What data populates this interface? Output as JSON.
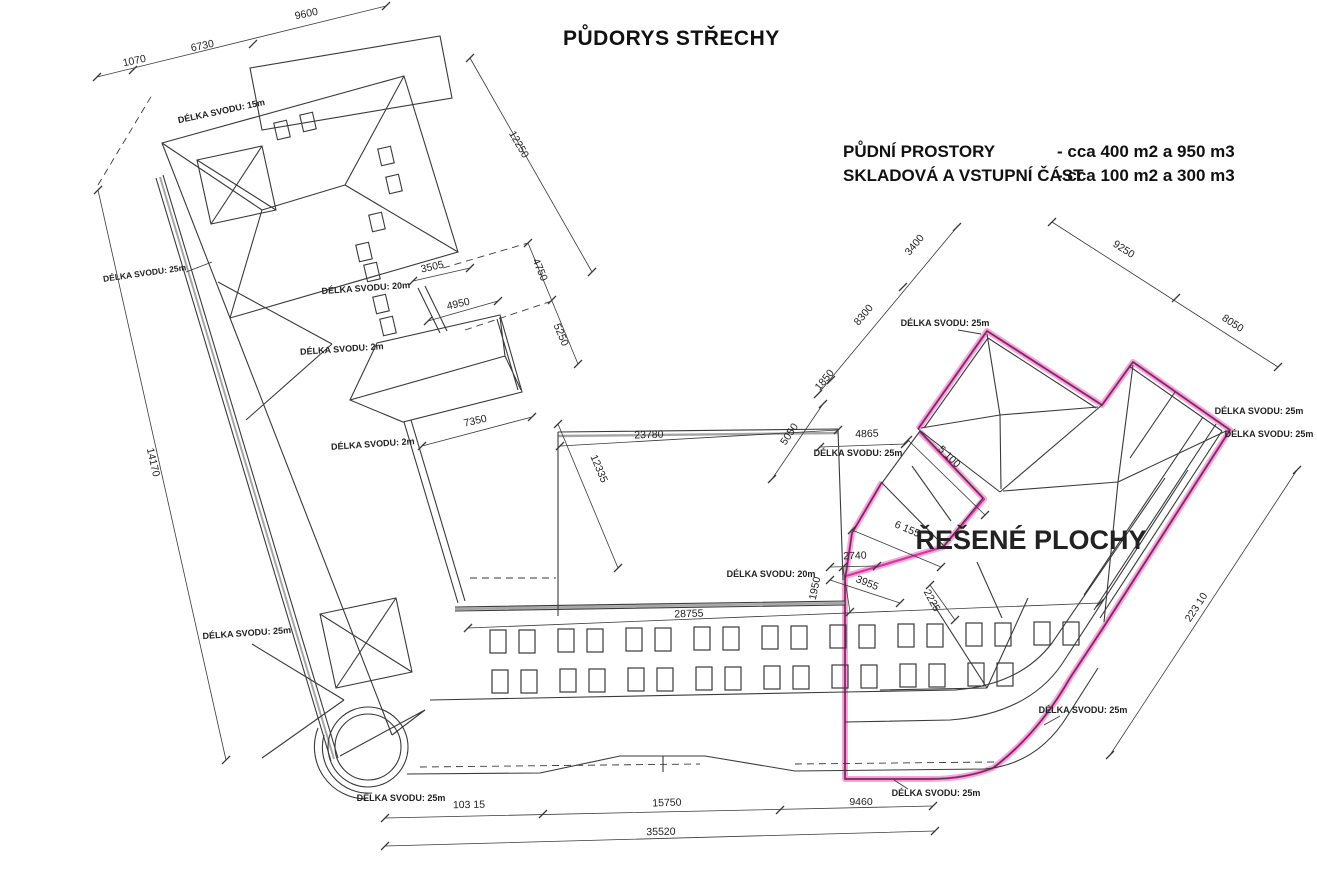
{
  "title": "PŮDORYS STŘECHY",
  "notes": {
    "line1_label": "PŮDNÍ PROSTORY",
    "line1_value": "- cca 400 m2 a 950 m3",
    "line2_label": "SKLADOVÁ A VSTUPNÍ ČÁST",
    "line2_value": "- cca 100 m2 a 300 m3"
  },
  "colors": {
    "background": "#ffffff",
    "ink": "#3a3a3a",
    "grey": "#a6a6a6",
    "highlight": "#d5359f",
    "highlight_light": "#f6a8dd"
  },
  "labels": [
    {
      "name": "dim-1070",
      "text": "1070",
      "x": 135,
      "y": 64,
      "rot": -12,
      "size": 10.5
    },
    {
      "name": "dim-6730",
      "text": "6730",
      "x": 203,
      "y": 49,
      "rot": -12,
      "size": 10.5
    },
    {
      "name": "dim-9600",
      "text": "9600",
      "x": 307,
      "y": 17,
      "rot": -12,
      "size": 10.5
    },
    {
      "name": "dim-12250",
      "text": "12250",
      "x": 516,
      "y": 146,
      "rot": 60,
      "size": 10.5
    },
    {
      "name": "dim-14170",
      "text": "14170",
      "x": 150,
      "y": 463,
      "rot": 77,
      "size": 10.5
    },
    {
      "name": "dim-3505",
      "text": "3505",
      "x": 433,
      "y": 270,
      "rot": -13,
      "size": 10.5
    },
    {
      "name": "dim-4950",
      "text": "4950",
      "x": 459,
      "y": 307,
      "rot": -13,
      "size": 10.5
    },
    {
      "name": "dim-4750",
      "text": "4750",
      "x": 537,
      "y": 271,
      "rot": 67,
      "size": 10.5
    },
    {
      "name": "dim-5250",
      "text": "5250",
      "x": 558,
      "y": 336,
      "rot": 67,
      "size": 10.5
    },
    {
      "name": "dim-7350",
      "text": "7350",
      "x": 476,
      "y": 424,
      "rot": -13,
      "size": 10.5
    },
    {
      "name": "dim-23780",
      "text": "23780",
      "x": 649,
      "y": 438,
      "rot": -2,
      "size": 10.5
    },
    {
      "name": "dim-12335",
      "text": "12335",
      "x": 596,
      "y": 470,
      "rot": 67,
      "size": 10.5
    },
    {
      "name": "dim-5050",
      "text": "5050",
      "x": 792,
      "y": 436,
      "rot": -56,
      "size": 10.5
    },
    {
      "name": "dim-1950",
      "text": "1950",
      "x": 818,
      "y": 589,
      "rot": -78,
      "size": 10.5
    },
    {
      "name": "dim-28755",
      "text": "28755",
      "x": 689,
      "y": 617,
      "rot": -2,
      "size": 10.5
    },
    {
      "name": "dim-3400",
      "text": "3400",
      "x": 917,
      "y": 247,
      "rot": -50,
      "size": 10.5
    },
    {
      "name": "dim-8300",
      "text": "8300",
      "x": 866,
      "y": 317,
      "rot": -50,
      "size": 10.5
    },
    {
      "name": "dim-1850",
      "text": "1850",
      "x": 827,
      "y": 382,
      "rot": -50,
      "size": 10.5
    },
    {
      "name": "dim-4865",
      "text": "4865",
      "x": 867,
      "y": 437,
      "rot": -2,
      "size": 10.5
    },
    {
      "name": "dim-5100",
      "text": "5 100",
      "x": 947,
      "y": 459,
      "rot": 44,
      "size": 10.5
    },
    {
      "name": "dim-9250",
      "text": "9250",
      "x": 1122,
      "y": 252,
      "rot": 33,
      "size": 10.5
    },
    {
      "name": "dim-8050",
      "text": "8050",
      "x": 1231,
      "y": 326,
      "rot": 33,
      "size": 10.5
    },
    {
      "name": "dim-6155",
      "text": "6 155",
      "x": 906,
      "y": 532,
      "rot": 23,
      "size": 10.5
    },
    {
      "name": "dim-2740",
      "text": "2740",
      "x": 855,
      "y": 559,
      "rot": -2,
      "size": 10.5
    },
    {
      "name": "dim-3955",
      "text": "3955",
      "x": 866,
      "y": 586,
      "rot": 22,
      "size": 10.5
    },
    {
      "name": "dim-2225",
      "text": "2225",
      "x": 929,
      "y": 602,
      "rot": 62,
      "size": 10.5
    },
    {
      "name": "dim-22310",
      "text": "223 10",
      "x": 1199,
      "y": 609,
      "rot": -57,
      "size": 10.5
    },
    {
      "name": "dim-9460",
      "text": "9460",
      "x": 861,
      "y": 805,
      "rot": 0,
      "size": 10.5
    },
    {
      "name": "dim-10315",
      "text": "103 15",
      "x": 469,
      "y": 808,
      "rot": -1,
      "size": 10.5
    },
    {
      "name": "dim-15750",
      "text": "15750",
      "x": 667,
      "y": 806,
      "rot": -2,
      "size": 10.5
    },
    {
      "name": "dim-35520",
      "text": "35520",
      "x": 661,
      "y": 835,
      "rot": -1,
      "size": 10.5
    },
    {
      "name": "svod-label-15m",
      "text": "DÉLKA SVODU: 15m",
      "x": 222,
      "y": 114,
      "rot": -12,
      "size": 9,
      "w": 600
    },
    {
      "name": "svod-label-25m-left",
      "text": "DÉLKA SVODU: 25m",
      "x": 145,
      "y": 276,
      "rot": -8,
      "size": 8.5,
      "w": 600
    },
    {
      "name": "svod-label-20m-neck",
      "text": "DÉLKA SVODU: 20m",
      "x": 366,
      "y": 291,
      "rot": -4,
      "size": 9,
      "w": 600
    },
    {
      "name": "svod-label-2m-upper",
      "text": "DÉLKA SVODU: 2m",
      "x": 342,
      "y": 352,
      "rot": -4,
      "size": 9,
      "w": 600
    },
    {
      "name": "svod-label-2m-lower",
      "text": "DÉLKA SVODU: 2m",
      "x": 373,
      "y": 447,
      "rot": -4,
      "size": 9,
      "w": 600
    },
    {
      "name": "svod-label-25m-lowerleft",
      "text": "DÉLKA SVODU: 25m",
      "x": 247,
      "y": 636,
      "rot": -4,
      "size": 9,
      "w": 600
    },
    {
      "name": "svod-label-20m-court",
      "text": "DÉLKA SVODU: 20m",
      "x": 771,
      "y": 577,
      "rot": 0,
      "size": 9,
      "w": 600
    },
    {
      "name": "svod-label-25m-nw",
      "text": "DÉLKA SVODU: 25m",
      "x": 945,
      "y": 326,
      "rot": 0,
      "size": 9,
      "w": 600
    },
    {
      "name": "svod-label-25m-west",
      "text": "DÉLKA SVODU: 25m",
      "x": 858,
      "y": 456,
      "rot": 0,
      "size": 9,
      "w": 600
    },
    {
      "name": "svod-label-25m-right-1",
      "text": "DÉLKA SVODU: 25m",
      "x": 1259,
      "y": 414,
      "rot": 0,
      "size": 9,
      "w": 600
    },
    {
      "name": "svod-label-25m-right-2",
      "text": "DÉLKA SVODU: 25m",
      "x": 1269,
      "y": 437,
      "rot": 0,
      "size": 9,
      "w": 600
    },
    {
      "name": "svod-label-25m-curve",
      "text": "DÉLKA SVODU: 25m",
      "x": 1083,
      "y": 713,
      "rot": 0,
      "size": 9,
      "w": 600
    },
    {
      "name": "svod-label-25m-bottom-mid",
      "text": "DÉLKA SVODU: 25m",
      "x": 936,
      "y": 796,
      "rot": 0,
      "size": 9,
      "w": 600
    },
    {
      "name": "svod-label-25m-bottom-left",
      "text": "DÉLKA SVODU: 25m",
      "x": 401,
      "y": 801,
      "rot": 0,
      "size": 9,
      "w": 600
    },
    {
      "name": "area-title",
      "text": "ŘEŠENÉ PLOCHY",
      "x": 1031,
      "y": 549,
      "rot": 0,
      "size": 27,
      "w": 700
    }
  ]
}
